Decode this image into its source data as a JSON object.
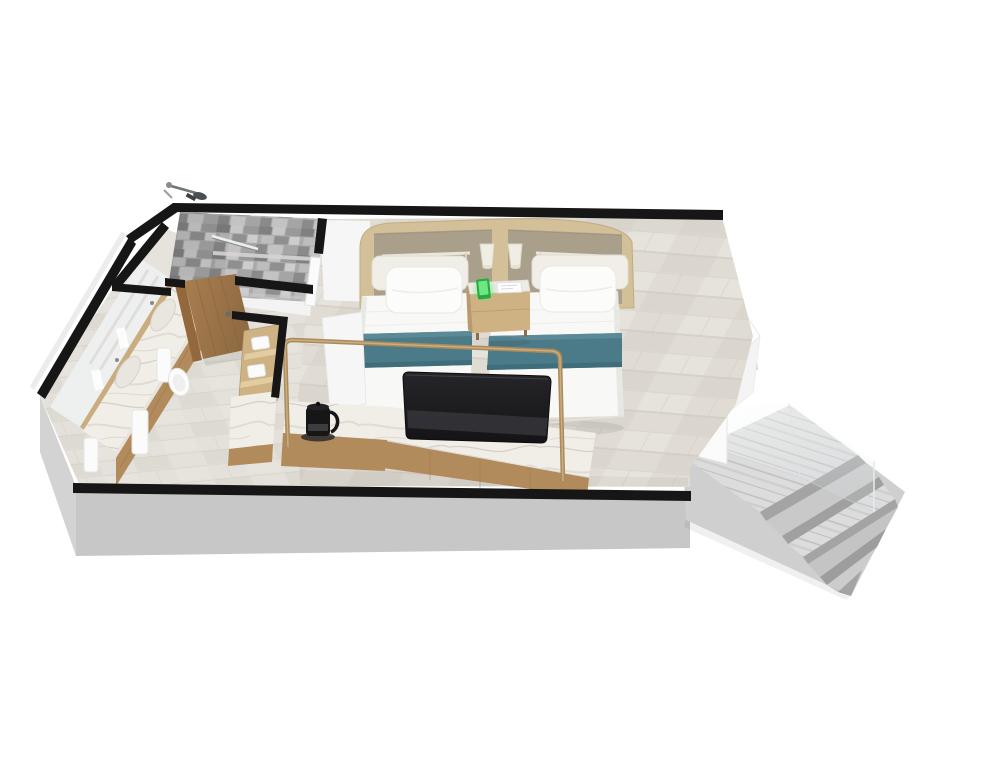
{
  "canvas": {
    "width": 1000,
    "height": 760,
    "background": "#ffffff"
  },
  "scene": {
    "type": "3d-floorplan-cutaway-render",
    "rooms": [
      "bathroom",
      "walk-in-shower",
      "entry",
      "twin-bedroom",
      "stair-landing"
    ],
    "objects": [
      "double-vanity",
      "vanity-mirror",
      "hanging-towels",
      "shower-handset",
      "shower-grab-bar",
      "bathroom-door",
      "toilet",
      "headboard",
      "wall-lamp-left",
      "wall-lamp-right",
      "twin-bed-left",
      "twin-bed-right",
      "nightstand",
      "phone-dock",
      "tv",
      "media-console",
      "kettle",
      "brass-railing",
      "shelf-unit",
      "glass-balustrade",
      "marble-staircase"
    ]
  },
  "colors": {
    "background": "#ffffff",
    "wallCut": "#161616",
    "wallWhite": "#f6f6f6",
    "wallShade": "#eeeeee",
    "wallEdge": "#ececec",
    "parapetWhite": "#fdfdfd",
    "parapetLower": "#f4f4f4",
    "plinthFront": "#c7c7c7",
    "plinthSide": "#d3d3d3",
    "floorBase": "#e0dcd4",
    "floorBandA": "#d5d0c7",
    "floorBandB": "#e9e6e0",
    "bathFloor": "#e4e1db",
    "entryFloor": "#e6e3dd",
    "showerFloor": "#dadad8",
    "grout": "#c8c2b8",
    "mosaicBase": "#ababab",
    "mosaicDark": "#7d7d7d",
    "mosaicLight": "#cdcdcd",
    "tileShelf": "#d4d4d4",
    "marbleBase": "#f1eee8",
    "marbleVein": "#cac3b8",
    "stairBase": "#cfcfcf",
    "stairLight": "#dcdcdc",
    "stairMid": "#c9c9c9",
    "stairDark": "#a4a4a4",
    "glassEdge": "#cfd6d9",
    "newelWhite": "#fbfbfb",
    "woodDoor": "#a87e50",
    "woodDoorDark": "#8f6a42",
    "woodJamb": "#93683d",
    "woodCabinet": "#b28b5c",
    "woodGrain": "#9c7849",
    "woodTop": "#cfb284",
    "woodShelf": "#e2cda2",
    "headboardWood": "#d3bf98",
    "fabricTaupe": "#a99f8b",
    "railWood": "#eae6da",
    "lampCream": "#f0eee3",
    "cushionCream": "#f0eee7",
    "pillowWhite": "#fcfcfb",
    "bedWhite": "#f8f8f6",
    "bedShade": "#e7e7e3",
    "runnerTeal": "#4b7b89",
    "runnerLight": "#5d8b98",
    "runnerDark": "#3e6b78",
    "nightstandTop": "#ecebe4",
    "panelWhite": "#fdfdfd",
    "phoneGreen": "#27a93f",
    "phoneScreen": "#6fe586",
    "glowGreen": "#52e96f",
    "tvReflect": "#35353b",
    "brass": "#ab8a5b",
    "brassLight": "#cdb184",
    "kettleBlack": "#161616",
    "mirrorFill": "#eef0ef",
    "mirrorFrame": "#c9ad80",
    "chromeLight": "#eceff0",
    "chromeDark": "#82888b",
    "towelWhite": "#fbfbfb"
  }
}
